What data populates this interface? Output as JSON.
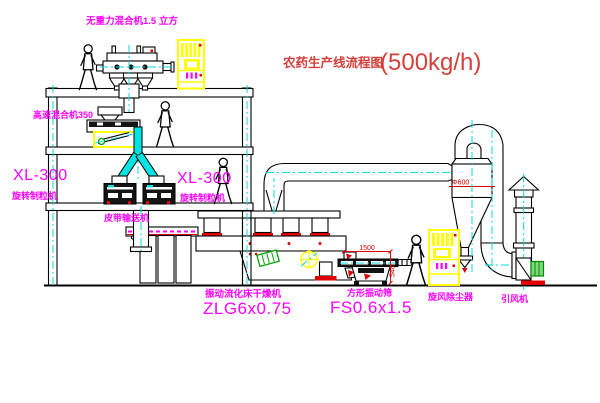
{
  "diagram": {
    "title": "农药生产线流程图",
    "capacity": "(500kg/h)"
  },
  "labels": {
    "zero_gravity_mixer": "无重力混合机1.5 立方",
    "high_speed_mixer": "高速混合机350",
    "granulator_left_model": "XL-300",
    "granulator_left_name": "旋转制粒机",
    "granulator_right_model": "XL-300",
    "granulator_right_name": "旋转制粒机",
    "belt_conveyor": "皮带输送机",
    "dryer_name": "振动流化床干燥机",
    "dryer_model": "ZLG6x0.75",
    "screen_name": "方形振动筛",
    "screen_model": "FS0.6x1.5",
    "cyclone": "旋风除尘器",
    "fan": "引风机"
  },
  "dimensions": {
    "screen_length": "1500",
    "screen_height": "548",
    "cyclone_note": "Φ600"
  },
  "colors": {
    "label": "#ff00ff",
    "title": "#d4403a",
    "dimension": "#e00000",
    "centerline": "#00dcdc",
    "cabinet": "#ffff00",
    "line": "#000000",
    "motor_green": "#00a000"
  }
}
